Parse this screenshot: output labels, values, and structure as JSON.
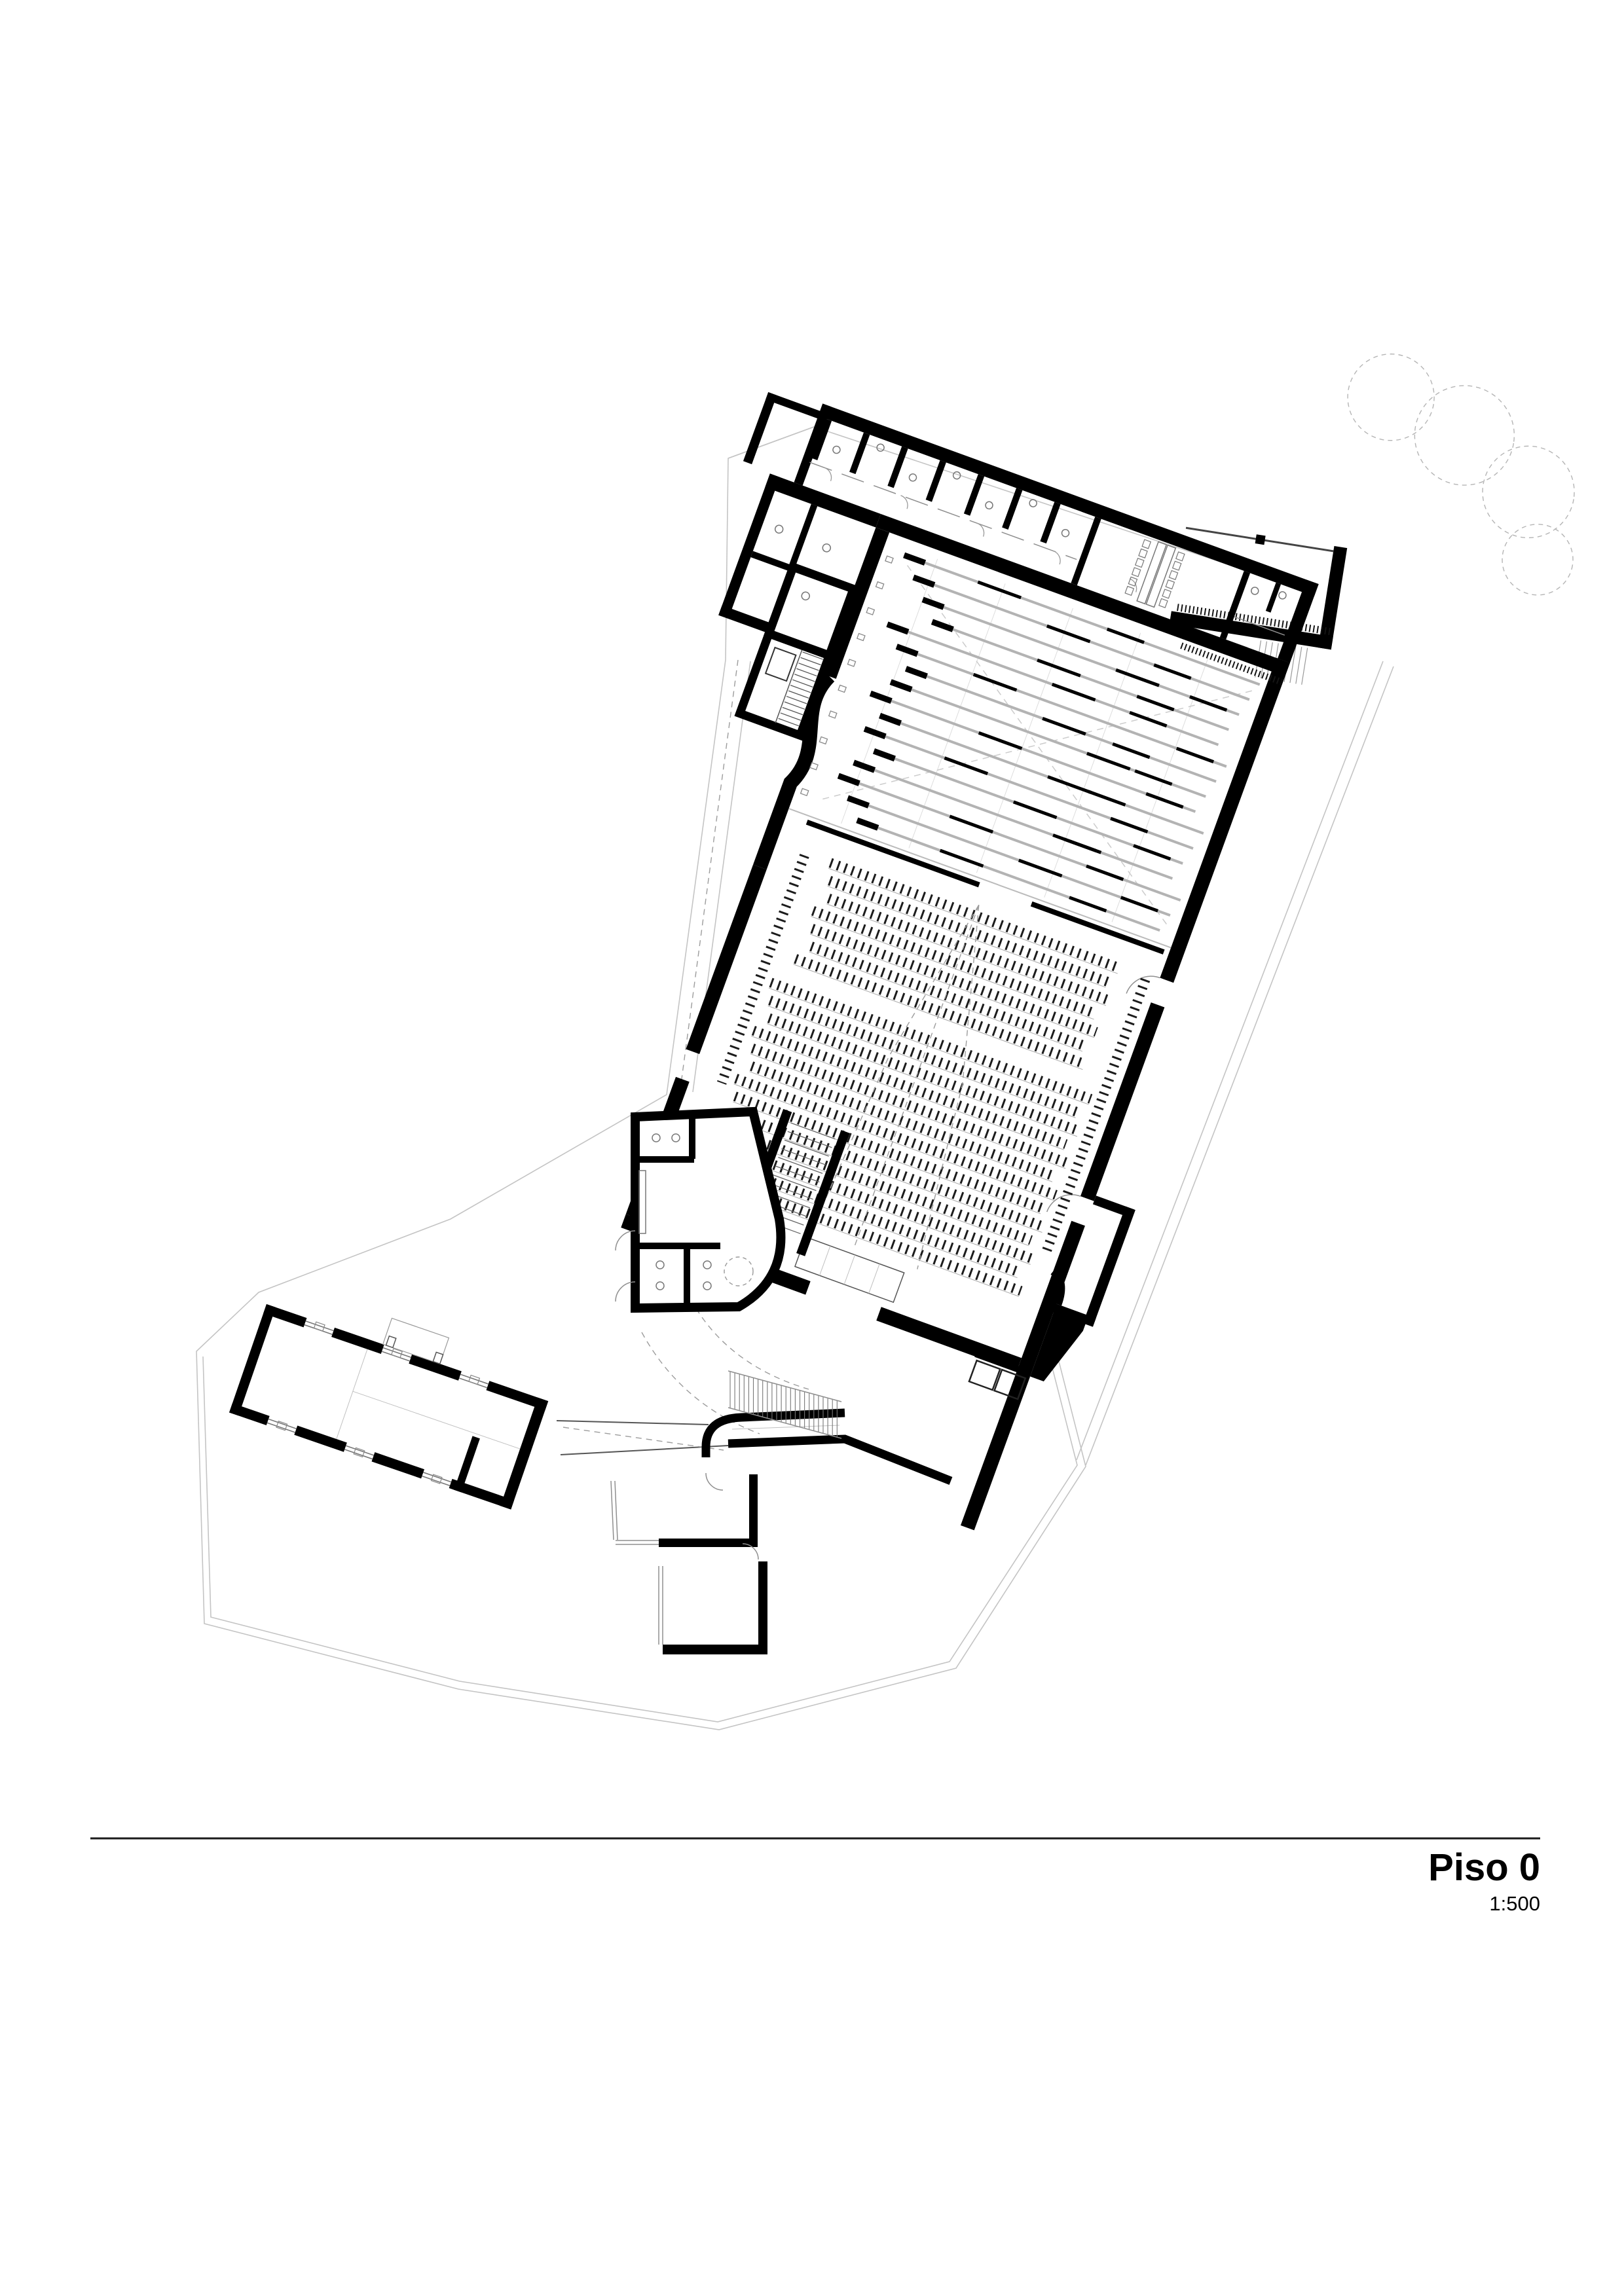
{
  "title_block": {
    "title": "Piso 0",
    "scale": "1:500"
  },
  "colors": {
    "wall": "#000000",
    "lane_gray": "#b3b3b3",
    "seat_dark": "#1c1c1c",
    "line_mid": "#8f8f8f",
    "line_light": "#c4c4c4",
    "dash": "#9c9c9c"
  },
  "plan": {
    "hall_rotation_deg": 20,
    "annex_rotation_deg": 9,
    "sw_wing_rotation_deg": 19,
    "stage": {
      "lanes": 16,
      "batten_lines": 5,
      "wall_ticks": 10
    },
    "seating": {
      "upper_rows": 7,
      "lower_rows": 13
    },
    "top_wing": {
      "wc_partitions": 7,
      "meeting_chairs_per_side": 6,
      "door_arcs": 5
    },
    "annex": {
      "trees": 4,
      "terrace_steps": 9
    },
    "stairs": {
      "entrance_steps": 24,
      "left_block_steps": 13,
      "inner_steps": 12,
      "tower_steps": 8
    }
  }
}
